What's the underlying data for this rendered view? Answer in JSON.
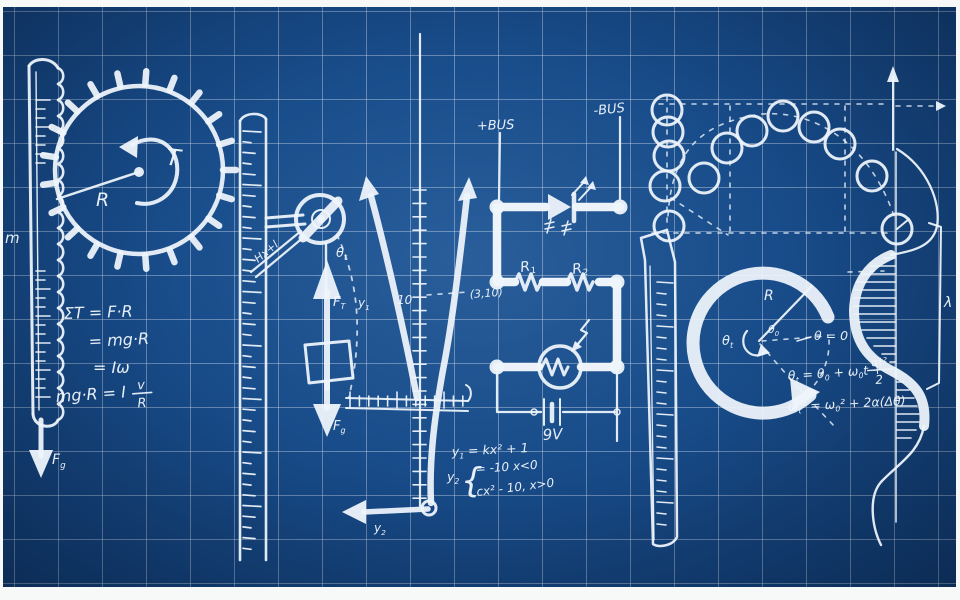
{
  "artwork": {
    "word": "physics",
    "colors": {
      "background": "#174a87",
      "ink": "#eef4fb",
      "grid": "#d0dae8",
      "frame": "#f7f8f8"
    }
  },
  "letter_p": {
    "mass_label": "m",
    "weight_label": {
      "base": "F",
      "sub": "g"
    },
    "radius_label": "R",
    "torque_label": "T",
    "equations": {
      "line1": "ΣT = F·R",
      "line2": "= mg·R",
      "line3": "= Iω",
      "line4_left": "mg·R = I",
      "line4_num": "v",
      "line4_den": "R"
    }
  },
  "letter_h": {
    "brace_label": "Hx+l",
    "angle_label": {
      "base": "θ",
      "sub": "t"
    },
    "tension_label": {
      "base": "F",
      "sub": "T"
    },
    "weight_label": {
      "base": "F",
      "sub": "g"
    }
  },
  "letter_y": {
    "left_arm_label": {
      "base": "y",
      "sub": "1"
    },
    "tick_label": "10",
    "point_label": "(3,10)",
    "descender_label": {
      "base": "y",
      "sub": "2"
    },
    "eq1": {
      "lhs": "y",
      "lhs_sub": "1",
      "rhs": " = kx² + 1"
    },
    "eq2": {
      "lhs": "y",
      "lhs_sub": "2",
      "brace": "{",
      "case1": "= -10  x<0",
      "case2": "cx² - 10,  x>0"
    }
  },
  "letter_s_circuit": {
    "bus_positive": "+BUS",
    "bus_negative": "-BUS",
    "resistor1": {
      "base": "R",
      "sub": "1"
    },
    "resistor2": {
      "base": "R",
      "sub": "2"
    },
    "battery": "9V"
  },
  "letter_c": {
    "radius_label": "R",
    "angle_t": {
      "base": "θ",
      "sub": "t"
    },
    "angle_0": {
      "base": "θ",
      "sub": "0"
    },
    "eq_zero": "θ = 0",
    "eq_theta": {
      "p1": "θ",
      "s1": "t",
      "p2": " = θ",
      "s2": "0",
      "p3": " + ω",
      "s3": "0",
      "p4": "t + "
    },
    "eq_theta_num": "αt²",
    "eq_theta_den": "2",
    "eq_omega": {
      "p1": "ω",
      "s1": "t",
      "p2": "² = ω",
      "s2": "0",
      "p3": "² + 2α(Δθ)"
    }
  },
  "letter_s_wave": {
    "wavelength_label": "λ"
  }
}
